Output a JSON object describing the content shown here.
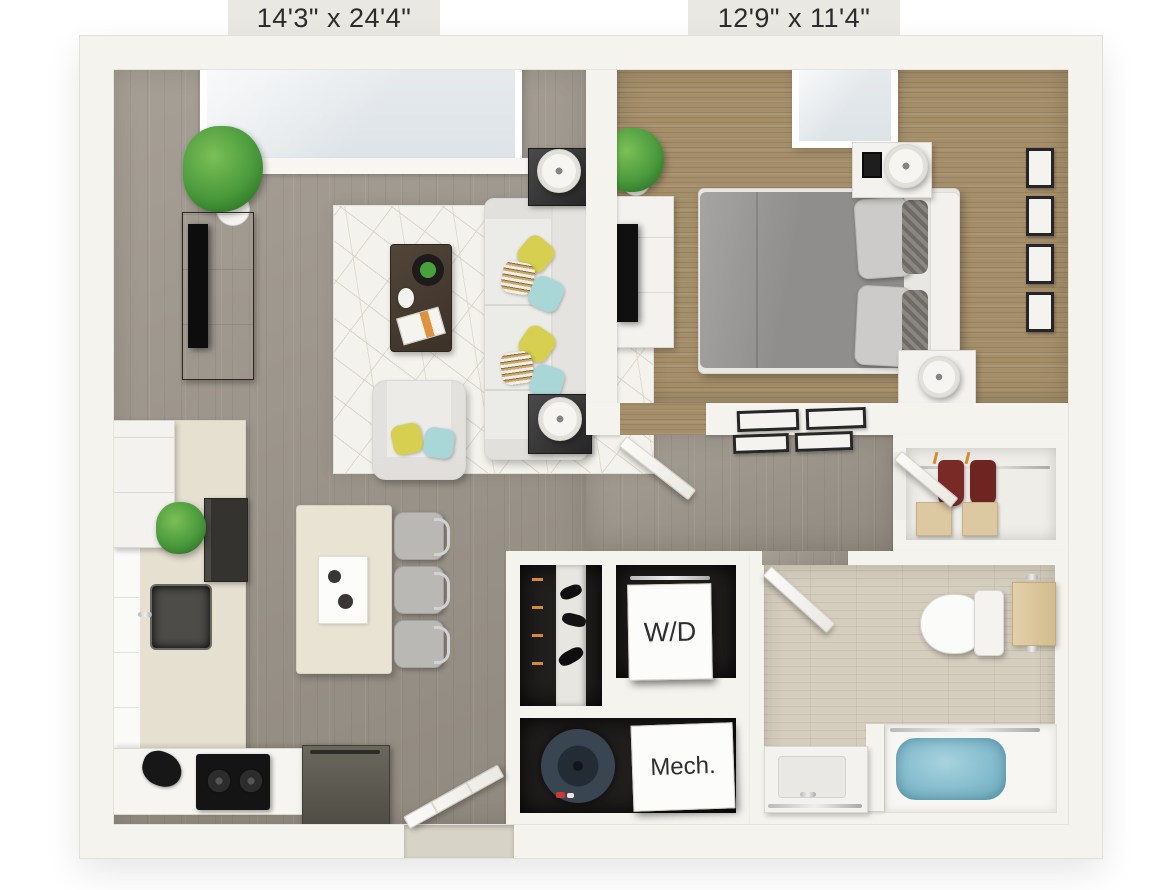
{
  "plan": {
    "living_area": {
      "dimensions_label": "14'3\" x 24'4\""
    },
    "bedroom": {
      "dimensions_label": "12'9\" x 11'4\""
    },
    "laundry": {
      "label": "W/D"
    },
    "mechanical": {
      "label": "Mech."
    }
  },
  "colors": {
    "wall": "#f5f3ee",
    "wood_floor": "#9a9389",
    "bedroom_carpet": "#a58f6a",
    "bathroom_tile": "#d5cebe",
    "dark_room": "#211f1e",
    "accent_pillow_yellow": "#d6cf4f",
    "accent_pillow_teal": "#a9d7d8",
    "plant_green": "#4a9a3c",
    "dark_wood_furniture": "#463a2f",
    "bathtub_water": "#85bccd",
    "towel_tan": "#dcc89e",
    "water_heater": "#44505c"
  }
}
